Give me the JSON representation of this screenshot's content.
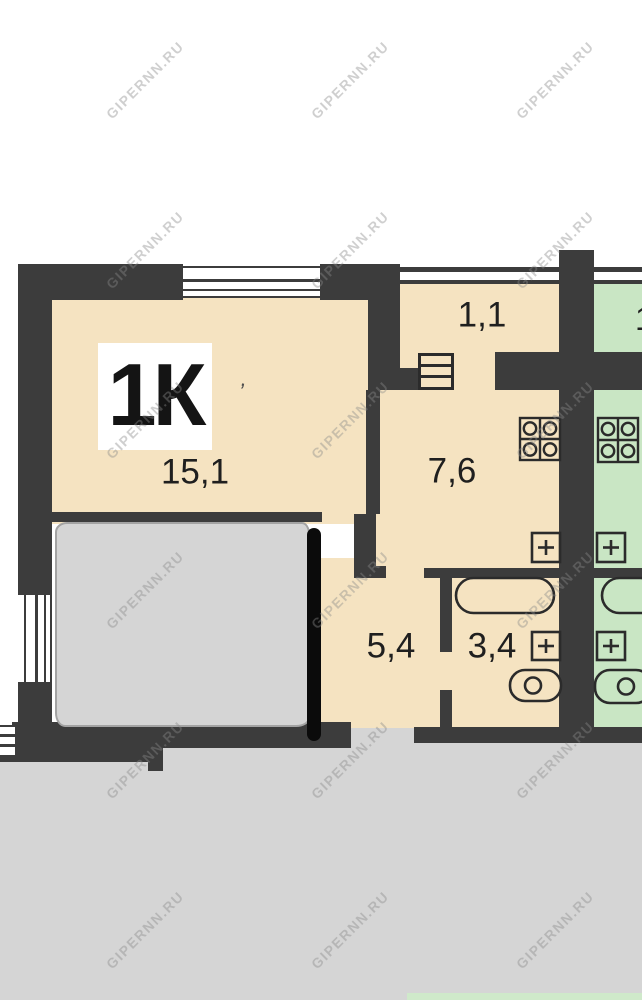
{
  "plan": {
    "unit_label": "1К",
    "stray_mark": ","
  },
  "rooms": {
    "living": {
      "area": "15,1"
    },
    "kitchen": {
      "area": "7,6"
    },
    "balcony": {
      "area": "1,1"
    },
    "hallway": {
      "area": "5,4"
    },
    "bathroom": {
      "area": "3,4"
    }
  },
  "neighbor": {
    "partial_area_label": "1"
  },
  "watermark": {
    "text": "GIPERNN.RU"
  },
  "colors": {
    "page-white": "#ffffff",
    "wall": "#3c3c3c",
    "floor-cream": "#f5e3c1",
    "floor-green": "#c9e6c4",
    "erased-gray": "#d5d5d5",
    "marker-black": "#0b0b0b",
    "outline-dark": "#2b2b2b",
    "label-text": "#1f1f1f",
    "watermark-gray": "#8a8a8a",
    "green-strip": "#cfe9ca"
  }
}
